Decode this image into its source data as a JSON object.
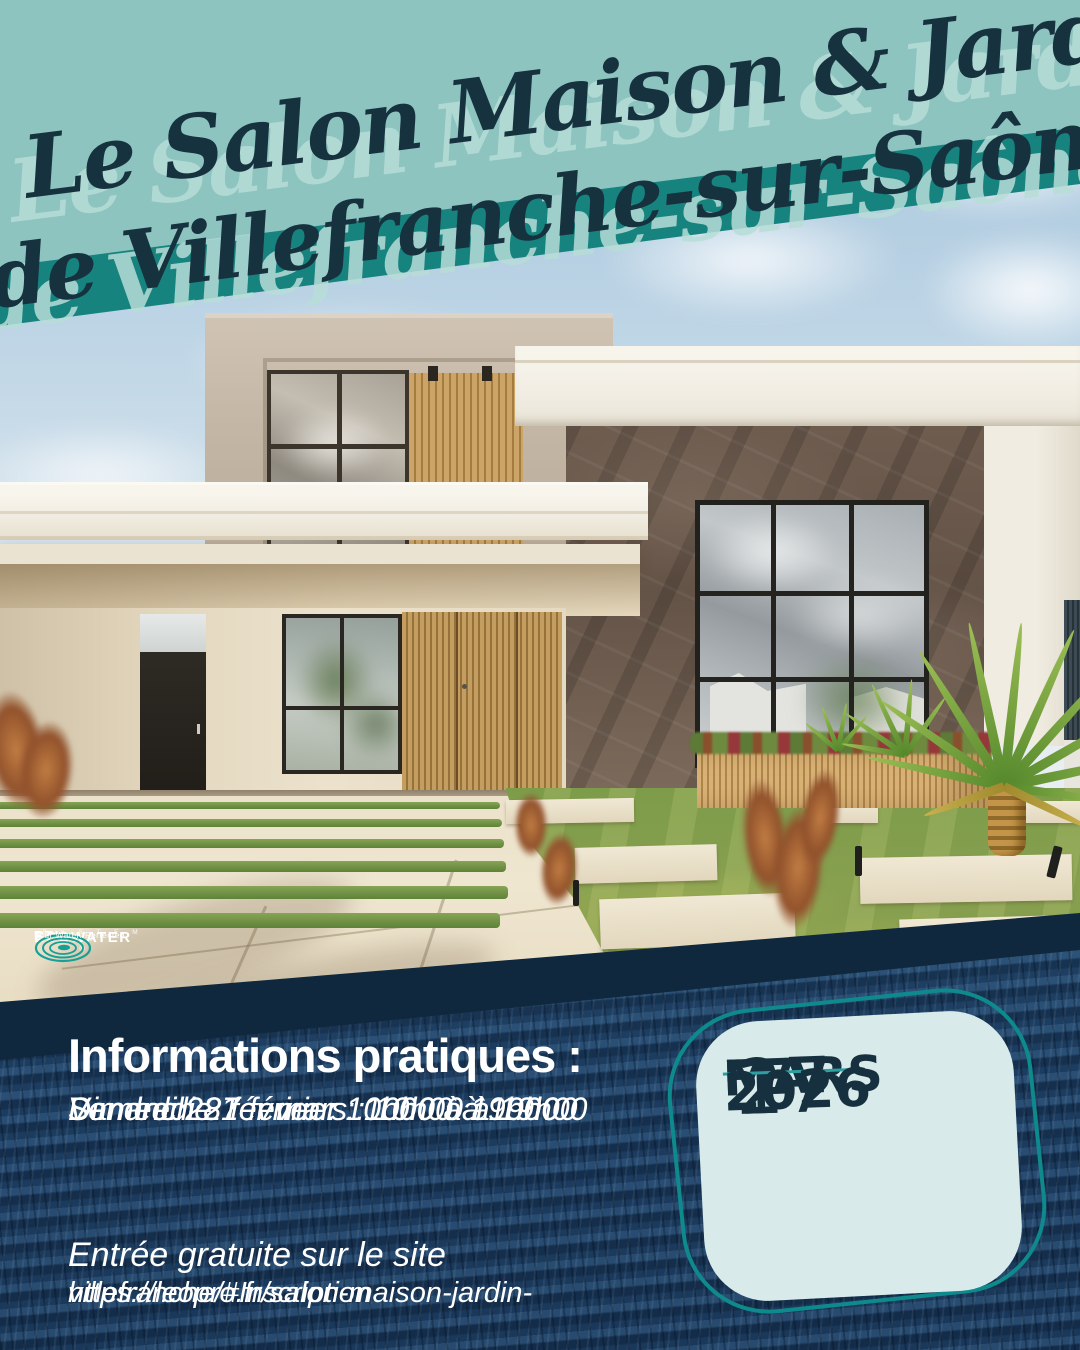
{
  "banner": {
    "line1": "Le Salon Maison & Jardin",
    "line2": "de Villefranche-sur-Saône",
    "bg_light_color": "#8ec4bf",
    "stripe_color": "#17837f",
    "text_color": "#17323f",
    "ghost_color": "#b7ddd7"
  },
  "logo": {
    "etl": "ETL",
    "name": "ECOWATER",
    "reg": "®",
    "systems": "S Y S T E M S",
    "tagline": "Your Water. Perfected.",
    "ripple_color": "#16a096"
  },
  "info": {
    "heading": "Informations pratiques :",
    "schedule": [
      "Vendredi 27 février : 10h00 à 19h00",
      "Samedi 28 février : 10h00 à 19h00",
      "Dimanche 1er mars : 10h00 à 19h00"
    ],
    "entry": "Entrée gratuite sur le site",
    "url_line1": "https://leopro.fr/salon-maison-jardin-",
    "url_line2": "villefranche/#Inscription",
    "text_color": "#ffffff",
    "background_color": "#10283d"
  },
  "badge": {
    "day_start": "27",
    "day_end": "1",
    "month_start": "FEV",
    "month_end": "MARS",
    "year": "2026",
    "fill_color": "#d8ebea",
    "outline_color": "#0e8a8d",
    "text_color": "#16303f"
  }
}
